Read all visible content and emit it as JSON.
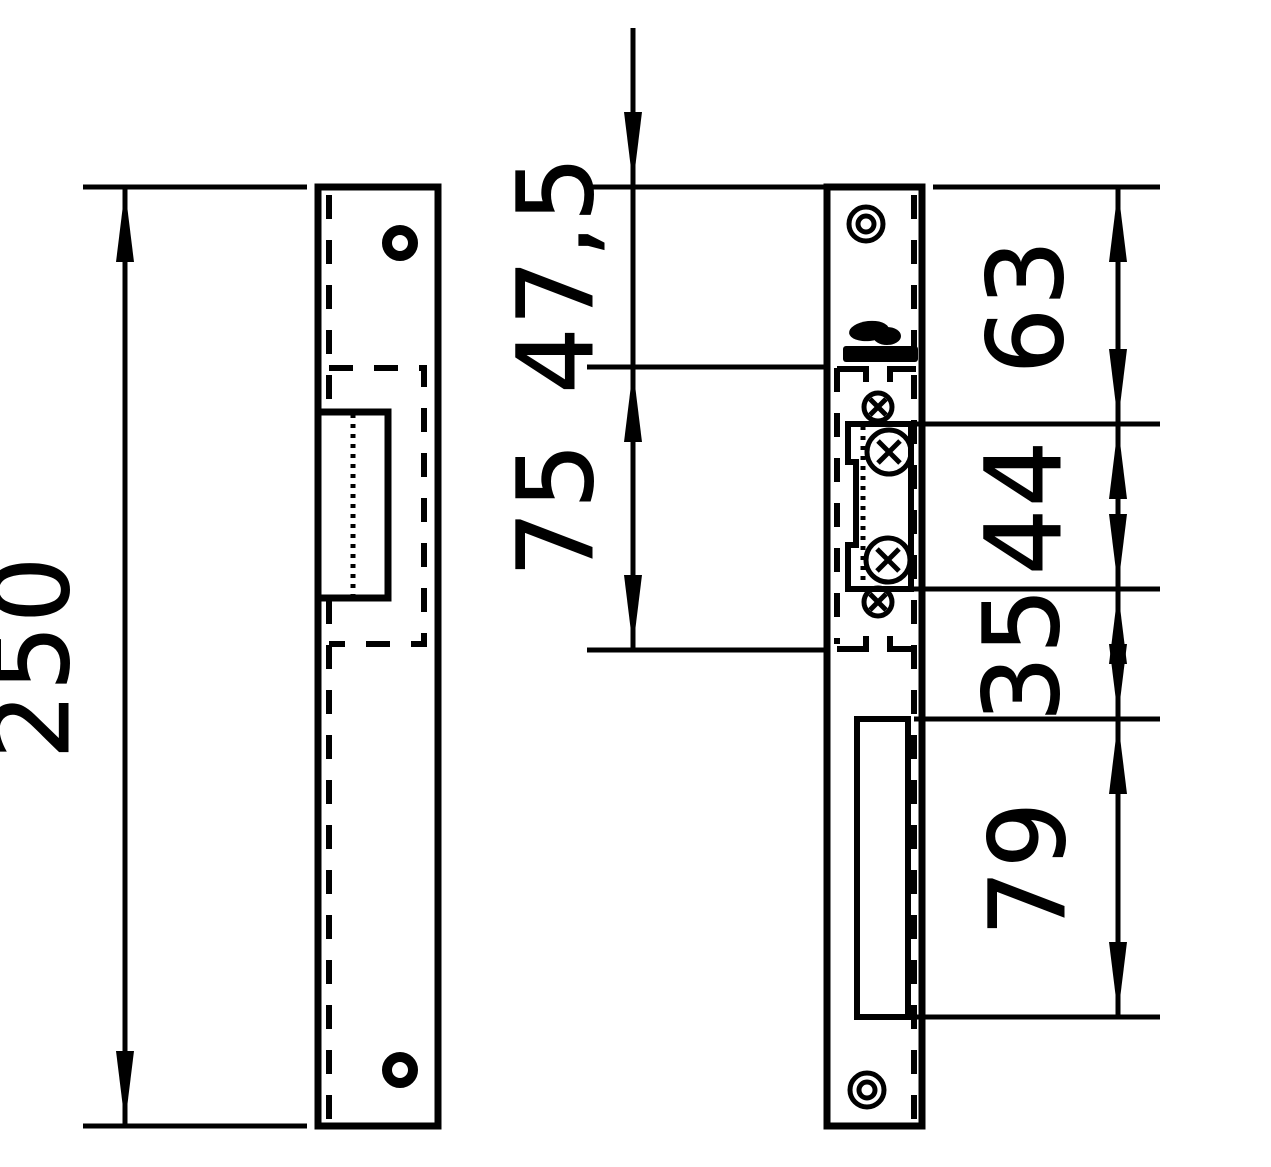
{
  "page": {
    "background": "#ffffff",
    "ink": "#000000",
    "kind": "technical dimension drawing, electric strike faceplate, two views"
  },
  "dimensions": {
    "overall_height": "250",
    "top_to_latch_recess": "47,5",
    "latch_recess_height": "75",
    "top_to_keeper": "63",
    "keeper_height": "44",
    "keeper_to_lower_cutout": "35",
    "lower_cutout_height": "79"
  }
}
